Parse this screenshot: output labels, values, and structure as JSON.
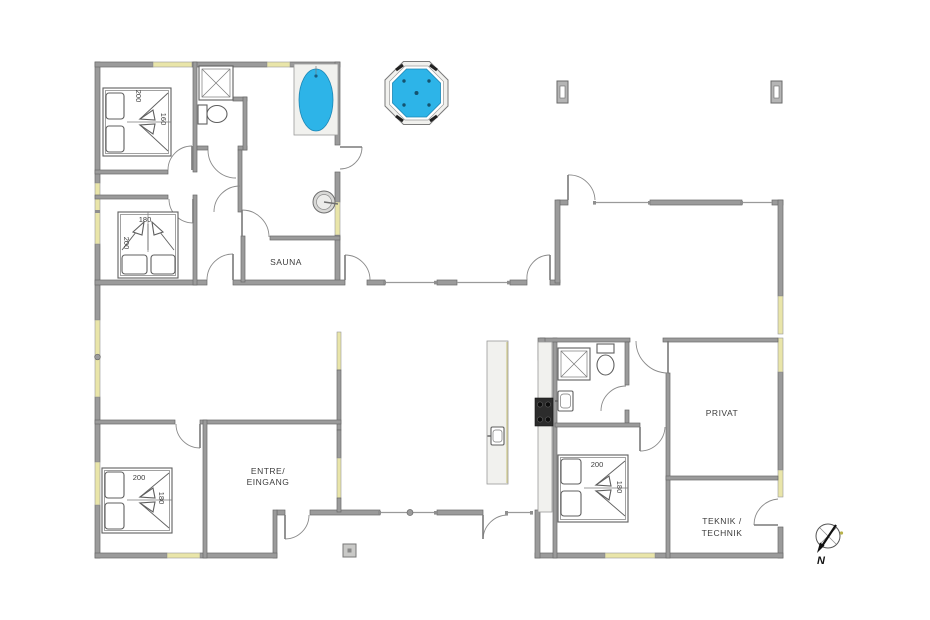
{
  "rooms": {
    "sauna": "SAUNA",
    "entre_line1": "ENTRE/",
    "entre_line2": "EINGANG",
    "privat": "PRIVAT",
    "teknik_line1": "TEKNIK /",
    "teknik_line2": "TECHNIK"
  },
  "beds": {
    "bed_top_left": {
      "length": "200",
      "width": "160"
    },
    "bed_mid_left": {
      "width": "180",
      "length": "200"
    },
    "bed_bottom_left": {
      "length": "200",
      "width": "180"
    },
    "bed_right": {
      "length": "200",
      "width": "180"
    }
  },
  "compass": {
    "north_label": "N"
  },
  "colors": {
    "wall": "#9b9b9b",
    "wall_edge": "#6a6a6a",
    "window": "#e9e5a9",
    "water": "#2db4e8",
    "cooktop": "#2c2c2c",
    "counter": "#f1f1ee",
    "line": "#5f5f5f"
  },
  "icons": {
    "shower": "shower-icon",
    "toilet": "toilet-icon",
    "bathtub": "bathtub-icon",
    "hot_tub": "hot-tub-icon",
    "sink": "sink-icon",
    "cooktop": "cooktop-icon",
    "round_basin": "round-basin-icon",
    "compass": "compass-icon"
  }
}
